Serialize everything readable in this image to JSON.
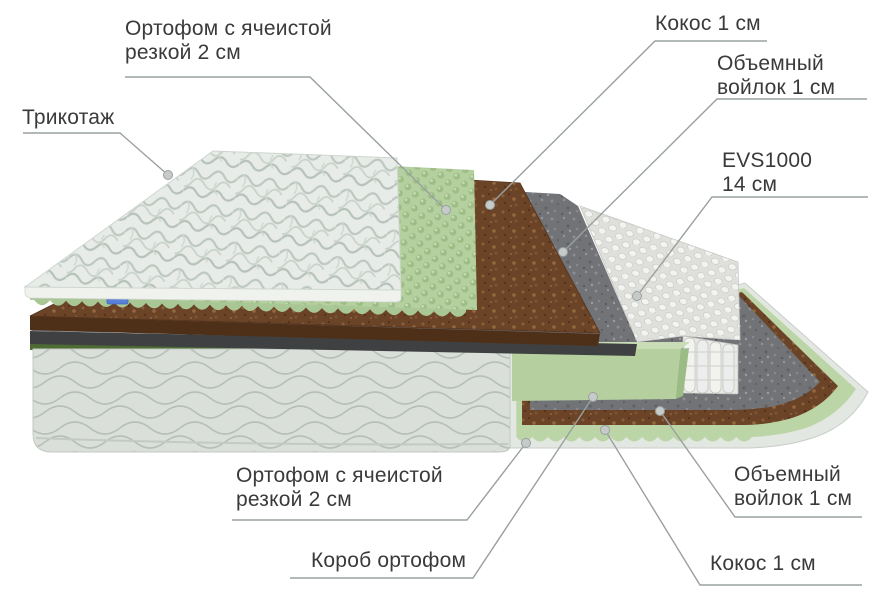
{
  "diagram": {
    "type": "mattress-layer-cutaway",
    "labels": {
      "trikotazh": {
        "text": "Трикотаж"
      },
      "ortofom_top": {
        "line1": "Ортофом с ячеистой",
        "line2": "резкой 2 см"
      },
      "kokos_top": {
        "text": "Кокос 1 см"
      },
      "voylok_top": {
        "line1": "Объемный",
        "line2": "войлок 1 см"
      },
      "evs": {
        "line1": "EVS1000",
        "line2": "14 см"
      },
      "ortofom_bottom": {
        "line1": "Ортофом с ячеистой",
        "line2": "резкой 2 см"
      },
      "korob": {
        "text": "Короб ортофом"
      },
      "voylok_bottom": {
        "line1": "Объемный",
        "line2": "войлок 1 см"
      },
      "kokos_bottom": {
        "text": "Кокос 1 см"
      }
    },
    "layers_top_to_bottom": [
      "Трикотаж",
      "Ортофом с ячеистой резкой 2 см",
      "Кокос 1 см",
      "Объемный войлок 1 см",
      "EVS1000 14 см",
      "Объемный войлок 1 см",
      "Кокос 1 см",
      "Ортофом с ячеистой резкой 2 см",
      "Короб ортофом"
    ],
    "colors": {
      "foam_green": "#b5d09f",
      "foam_green_dark": "#9dbd85",
      "box_edge_green": "#4d6b33",
      "coconut_brown": "#6b4427",
      "felt_gray": "#717377",
      "felt_dark_edge": "#3f4042",
      "spring_white": "#e2e3e0",
      "fabric_white": "#e8ece9",
      "side_fabric": "#dadfda",
      "label_text": "#3a3a3a",
      "leader_line": "#9aa0a0",
      "leader_dot": "#c6cbca",
      "brand_tag_blue": "#5b80d9"
    }
  }
}
